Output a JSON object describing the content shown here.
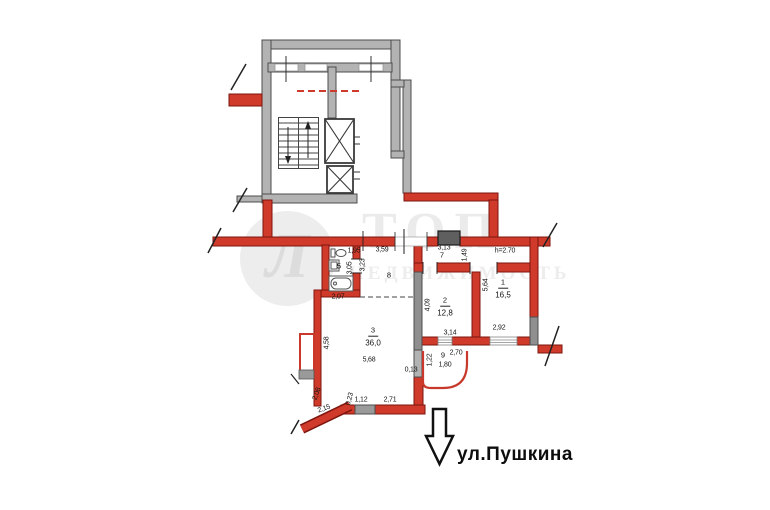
{
  "plan": {
    "street_label": "ул.Пушкина",
    "room_markers": [
      {
        "n": "1",
        "a": "16,5",
        "x": 503,
        "y": 286
      },
      {
        "n": "2",
        "a": "12,8",
        "x": 445,
        "y": 304
      },
      {
        "n": "3",
        "a": "36,0",
        "x": 373,
        "y": 334
      }
    ],
    "plain_markers": [
      {
        "t": "5",
        "x": 339,
        "y": 266
      },
      {
        "t": "7",
        "x": 442,
        "y": 255
      },
      {
        "t": "8",
        "x": 389,
        "y": 275
      },
      {
        "t": "9",
        "x": 443,
        "y": 355
      }
    ],
    "dimensions": [
      {
        "t": "1,95",
        "x": 354,
        "y": 251
      },
      {
        "t": "3,05",
        "x": 350,
        "y": 268,
        "r": -90
      },
      {
        "t": "3,23",
        "x": 363,
        "y": 265,
        "r": -90
      },
      {
        "t": "2,07",
        "x": 338,
        "y": 297
      },
      {
        "t": "3,59",
        "x": 382,
        "y": 250
      },
      {
        "t": "3,13",
        "x": 444,
        "y": 248
      },
      {
        "t": "1,49",
        "x": 465,
        "y": 255,
        "r": -90
      },
      {
        "t": "h=2.70",
        "x": 505,
        "y": 251
      },
      {
        "t": "5,64",
        "x": 486,
        "y": 285,
        "r": -90
      },
      {
        "t": "2,92",
        "x": 499,
        "y": 328
      },
      {
        "t": "4,09",
        "x": 428,
        "y": 305,
        "r": -90
      },
      {
        "t": "3,14",
        "x": 450,
        "y": 333
      },
      {
        "t": "2,70",
        "x": 456,
        "y": 353
      },
      {
        "t": "1,80",
        "x": 445,
        "y": 365
      },
      {
        "t": "1,22",
        "x": 430,
        "y": 360,
        "r": -90
      },
      {
        "t": "4,58",
        "x": 327,
        "y": 343,
        "r": -90
      },
      {
        "t": "5,68",
        "x": 369,
        "y": 360
      },
      {
        "t": "0,13",
        "x": 411,
        "y": 370
      },
      {
        "t": "2,71",
        "x": 390,
        "y": 400
      },
      {
        "t": "1,12",
        "x": 361,
        "y": 400
      },
      {
        "t": "0,23",
        "x": 350,
        "y": 399,
        "r": -75
      },
      {
        "t": "2,15",
        "x": 324,
        "y": 409,
        "r": -20
      },
      {
        "t": "2,08",
        "x": 317,
        "y": 394,
        "r": -70
      }
    ]
  },
  "watermark": {
    "logo_letter": "Л",
    "brand": "ТОП",
    "brand_line2": "НЕДВИЖИМОСТЬ"
  },
  "colors": {
    "wall_red": "#cf3a2b",
    "wall_red_edge": "#7e150e",
    "wall_gray": "#b3b3b3",
    "wall_gray_dark": "#8f8f8f",
    "watermark_gray": "#ededed",
    "arrow_black": "#111111"
  }
}
